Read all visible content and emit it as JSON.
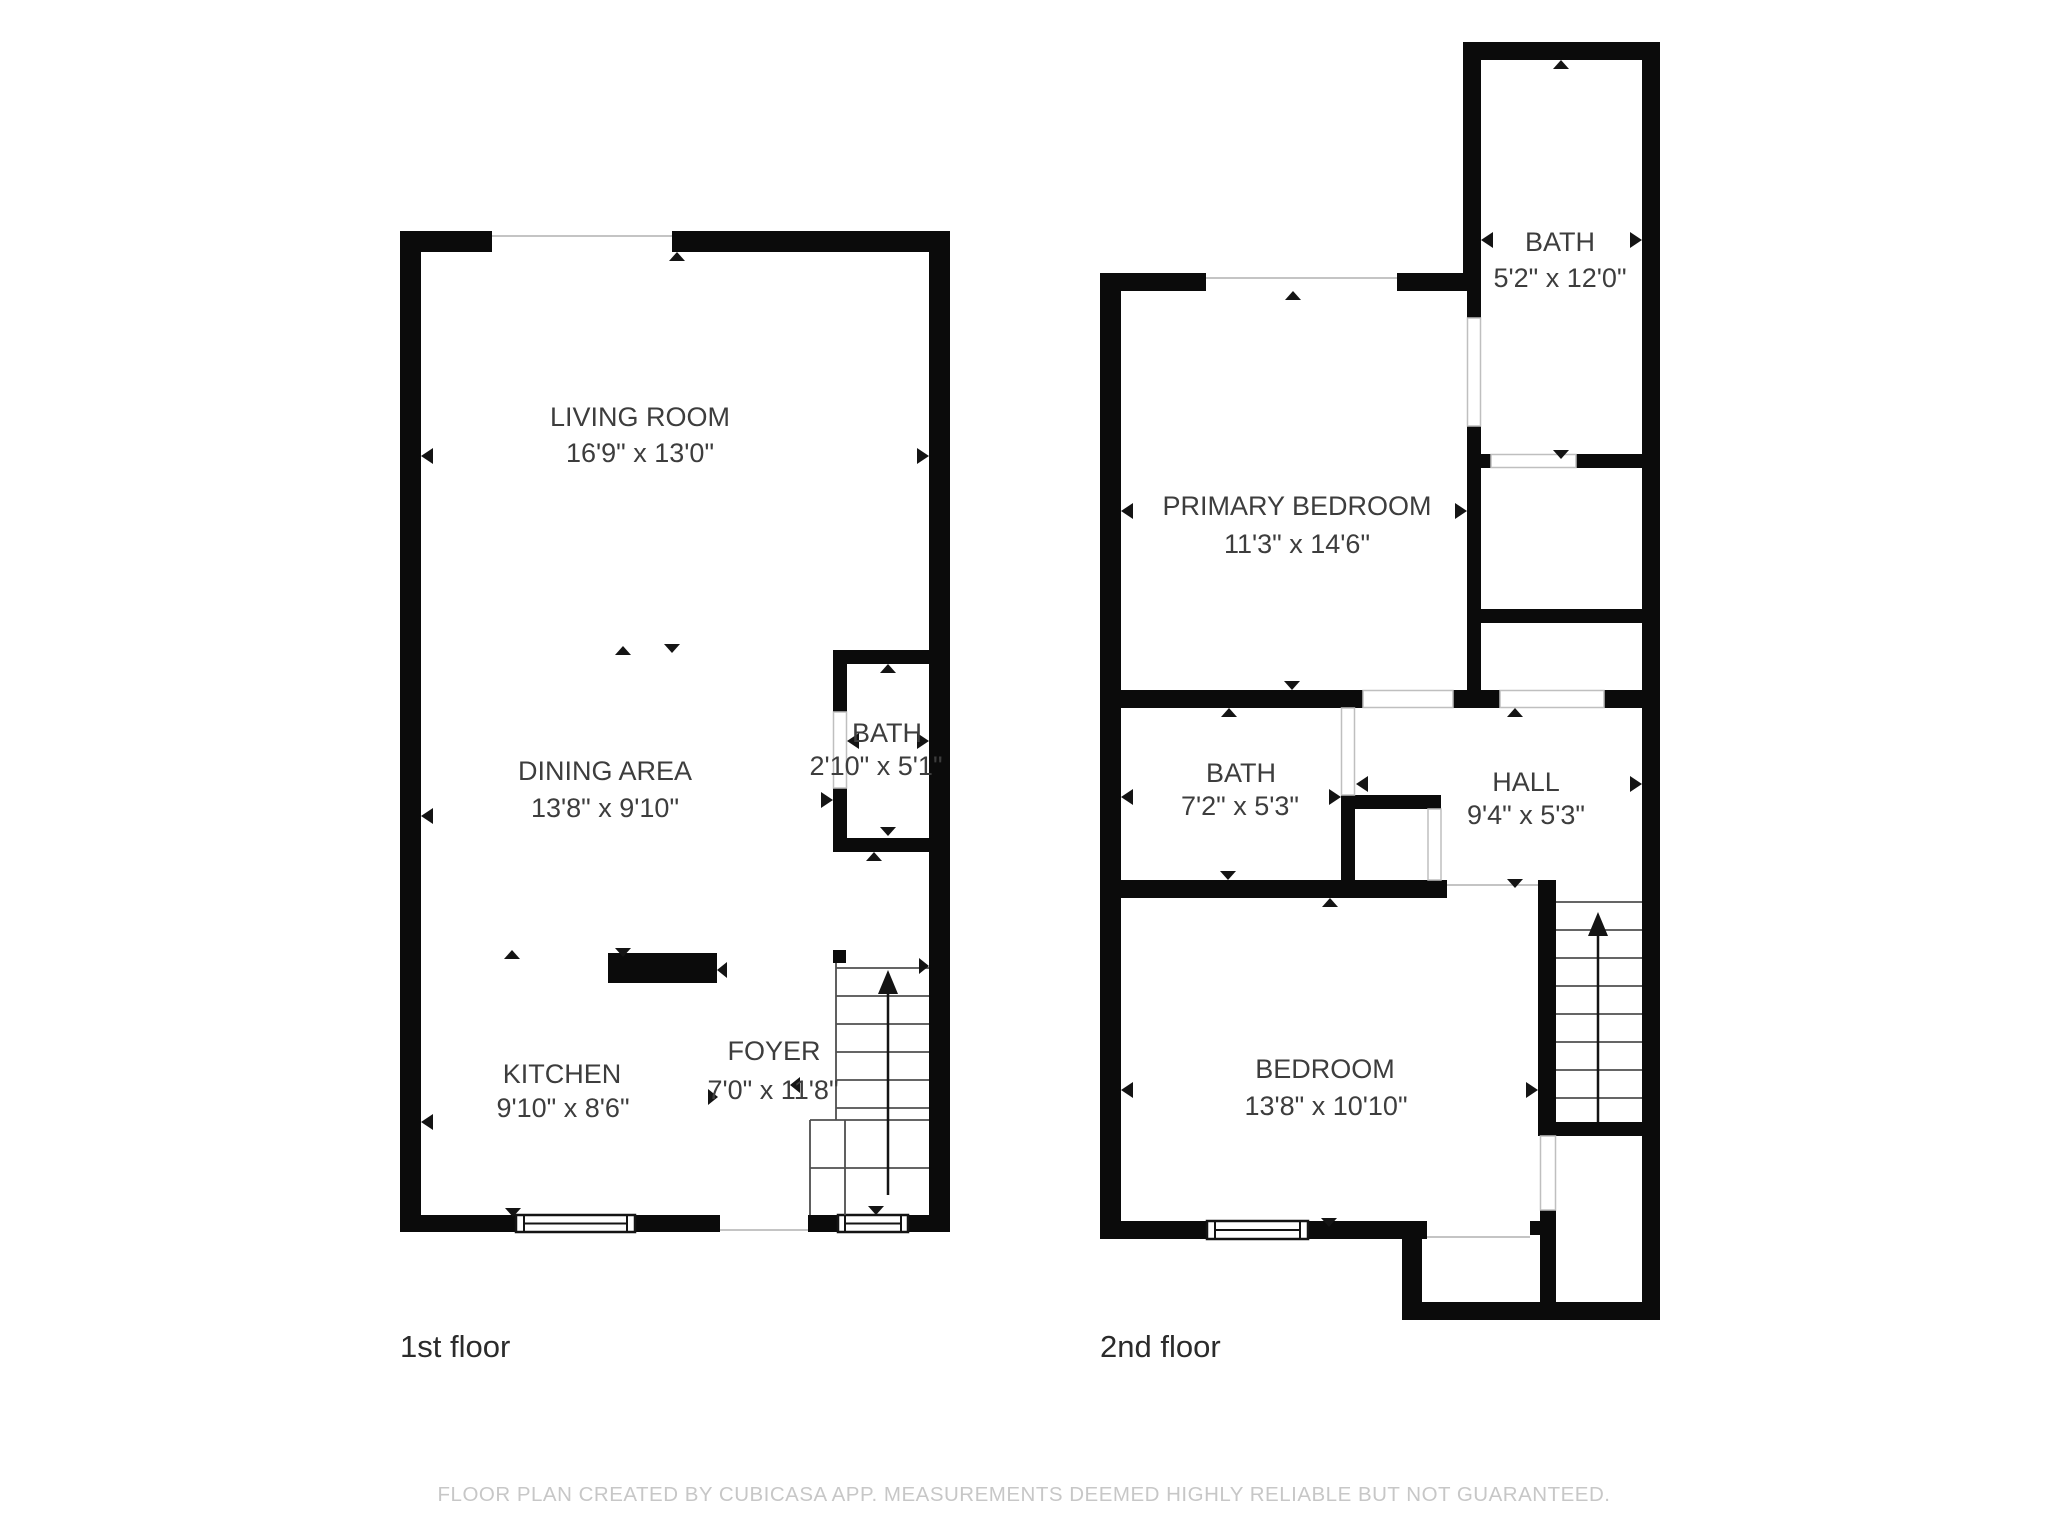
{
  "floors": [
    {
      "label": "1st floor",
      "rooms": [
        {
          "id": "living-room",
          "name": "LIVING ROOM",
          "dims": "16'9\" x 13'0\""
        },
        {
          "id": "dining-area",
          "name": "DINING AREA",
          "dims": "13'8\" x 9'10\""
        },
        {
          "id": "bath",
          "name": "BATH",
          "dims": "2'10\" x 5'1\""
        },
        {
          "id": "kitchen",
          "name": "KITCHEN",
          "dims": "9'10\" x 8'6\""
        },
        {
          "id": "foyer",
          "name": "FOYER",
          "dims": "7'0\" x 11'8\""
        }
      ]
    },
    {
      "label": "2nd floor",
      "rooms": [
        {
          "id": "bath-upper",
          "name": "BATH",
          "dims": "5'2\" x 12'0\""
        },
        {
          "id": "primary-bedroom",
          "name": "PRIMARY BEDROOM",
          "dims": "11'3\" x 14'6\""
        },
        {
          "id": "bath-mid",
          "name": "BATH",
          "dims": "7'2\" x 5'3\""
        },
        {
          "id": "hall",
          "name": "HALL",
          "dims": "9'4\" x 5'3\""
        },
        {
          "id": "bedroom",
          "name": "BEDROOM",
          "dims": "13'8\" x 10'10\""
        }
      ]
    }
  ],
  "footer": {
    "disclaimer": "FLOOR PLAN CREATED BY CUBICASA APP. MEASUREMENTS DEEMED HIGHLY RELIABLE BUT NOT GUARANTEED."
  },
  "colors": {
    "wall": "#0b0b0b",
    "room_text": "#3d3d3d",
    "floor_label_text": "#2b2b2b",
    "footer_text": "#c7c7c7",
    "background": "#ffffff"
  }
}
